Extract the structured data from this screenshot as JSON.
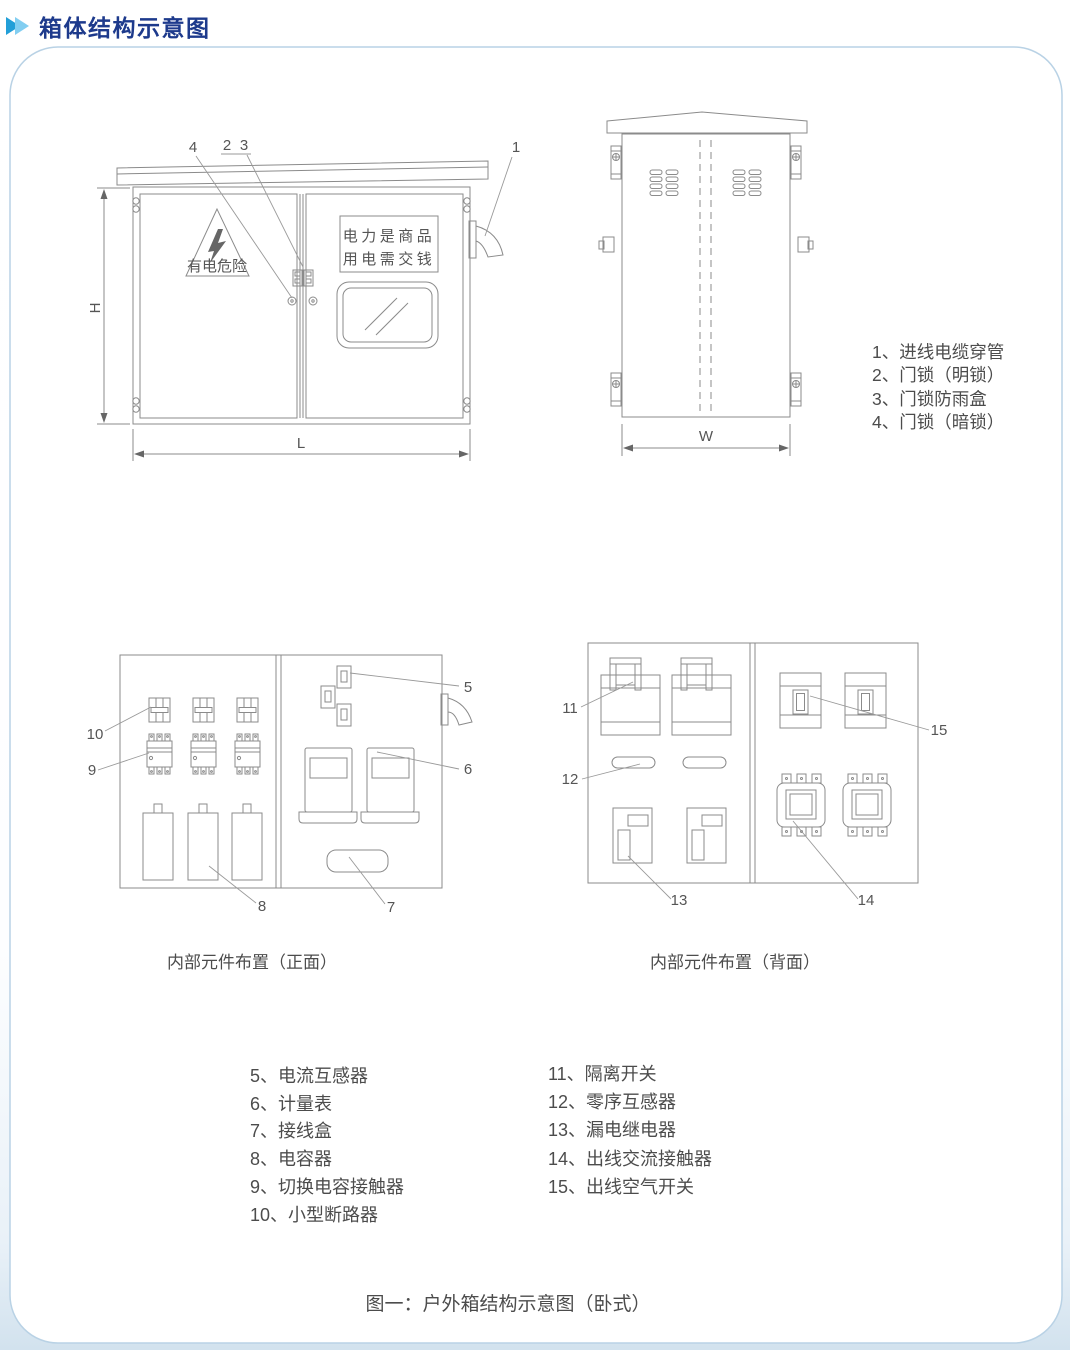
{
  "header": {
    "title": "箱体结构示意图"
  },
  "colors": {
    "title_text": "#1d3a8c",
    "arrow_dark": "#229fd8",
    "arrow_light": "#82cef1",
    "panel_border": "#b9d2e5",
    "line_art": "#8b8b8b",
    "body_text": "#4c4c4c"
  },
  "front_view": {
    "callout_1": "1",
    "callout_2": "2",
    "callout_3": "3",
    "callout_4": "4",
    "dim_height": "H",
    "dim_length": "L",
    "warning_text": "有电危险",
    "sign_line1": "电力是商品",
    "sign_line2": "用电需交钱"
  },
  "side_view": {
    "dim_width": "W"
  },
  "legend_locks": {
    "items": [
      "1、进线电缆穿管",
      "2、门锁（明锁）",
      "3、门锁防雨盒",
      "4、门锁（暗锁）"
    ]
  },
  "internal_front": {
    "caption": "内部元件布置（正面）",
    "callout_5": "5",
    "callout_6": "6",
    "callout_7": "7",
    "callout_8": "8",
    "callout_9": "9",
    "callout_10": "10"
  },
  "internal_back": {
    "caption": "内部元件布置（背面）",
    "callout_11": "11",
    "callout_12": "12",
    "callout_13": "13",
    "callout_14": "14",
    "callout_15": "15"
  },
  "legend_front": {
    "items": [
      "5、电流互感器",
      "6、计量表",
      "7、接线盒",
      "8、电容器",
      "9、切换电容接触器",
      "10、小型断路器"
    ]
  },
  "legend_back": {
    "items": [
      "11、隔离开关",
      "12、零序互感器",
      "13、漏电继电器",
      "14、出线交流接触器",
      "15、出线空气开关"
    ]
  },
  "figure_caption": "图一：户外箱结构示意图（卧式）"
}
